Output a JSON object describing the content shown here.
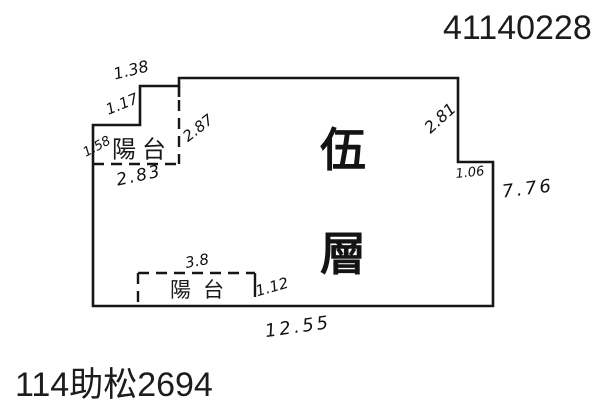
{
  "page": {
    "document_number": "41140228",
    "case_number": "114助松2694"
  },
  "floor_plan": {
    "floor_label_char1": "伍",
    "floor_label_char2": "層",
    "balconies": {
      "upper_left": {
        "label": "陽台"
      },
      "bottom": {
        "label": "陽台"
      }
    },
    "measurements": {
      "upper_balcony_top_width": "1.38",
      "upper_balcony_step_height": "1.17",
      "upper_balcony_right_height": "2.87",
      "upper_balcony_left_height": "1.58",
      "upper_balcony_bottom_width": "2.83",
      "right_upper_height": "2.81",
      "right_step_width": "1.06",
      "right_side_height": "7.76",
      "bottom_balcony_width": "3.8",
      "bottom_balcony_right_height": "1.12",
      "bottom_total_width": "12.55"
    },
    "colors": {
      "ink": "#161616",
      "background": "#ffffff"
    }
  }
}
